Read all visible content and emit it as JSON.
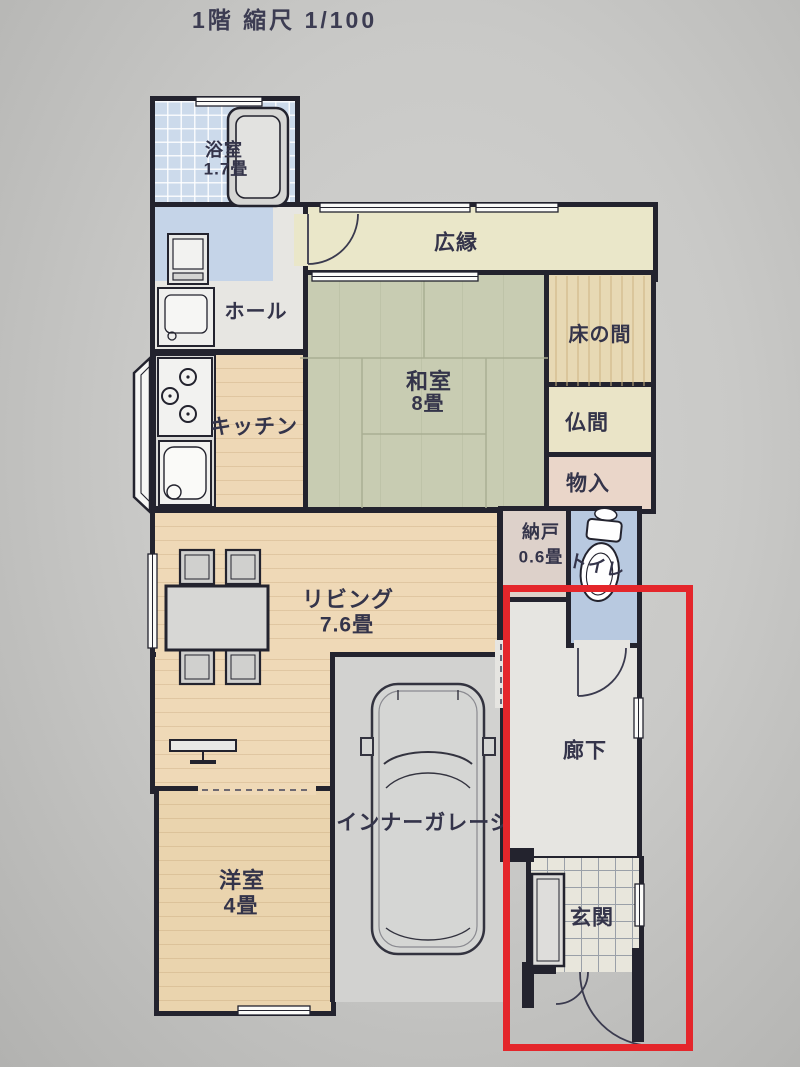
{
  "title": "1階 縮尺 1/100",
  "colors": {
    "paper": "#c9c9c7",
    "wall": "#23232e",
    "label_text": "#34344a",
    "highlight_red": "#e4262b"
  },
  "rooms": {
    "bath": {
      "name": "浴室",
      "size": "1.7畳",
      "floor": "#ccdaeb"
    },
    "washroom": {
      "floor": "#c5d4e8"
    },
    "hall": {
      "name": "ホール",
      "floor": "#e7e6e2"
    },
    "kitchen": {
      "name": "キッチン",
      "floor": "#eed8b6"
    },
    "veranda": {
      "name": "広縁",
      "floor": "#eae7c9"
    },
    "washitsu": {
      "name": "和室",
      "size": "8畳",
      "floor": "#c8ccb2"
    },
    "tokonoma": {
      "name": "床の間",
      "floor": "#e7d9b4"
    },
    "butsuma": {
      "name": "仏間",
      "floor": "#eae4c7"
    },
    "monoire": {
      "name": "物入",
      "floor": "#ead6c9"
    },
    "nando": {
      "name": "納戸",
      "size": "0.6畳",
      "floor": "#ddd1ca"
    },
    "toilet": {
      "name": "トイレ",
      "floor": "#b8c9e0"
    },
    "living": {
      "name": "リビング",
      "size": "7.6畳",
      "floor": "#efd9b7"
    },
    "corridor": {
      "name": "廊下",
      "floor": "#e6e5e1"
    },
    "garage": {
      "name": "インナーガレージ",
      "floor": "#d2d2d0"
    },
    "youshitsu": {
      "name": "洋室",
      "size": "4畳",
      "floor": "#ead4ae"
    },
    "genkan": {
      "name": "玄関",
      "floor": "#e8e6dc"
    }
  },
  "icons": {
    "bathtub": "bathtub-icon",
    "washing_machine": "washing-machine-icon",
    "vanity": "vanity-icon",
    "stove": "stove-icon",
    "kitchen_sink": "kitchen-sink-icon",
    "dining_table": "dining-table-icon",
    "chair": "chair-icon",
    "tv": "tv-icon",
    "car": "car-icon",
    "toilet_fixture": "toilet-icon",
    "shoe_cabinet": "shoe-cabinet-icon",
    "bay_window": "bay-window-icon",
    "door_arc": "door-arc-icon",
    "window": "window-icon"
  }
}
